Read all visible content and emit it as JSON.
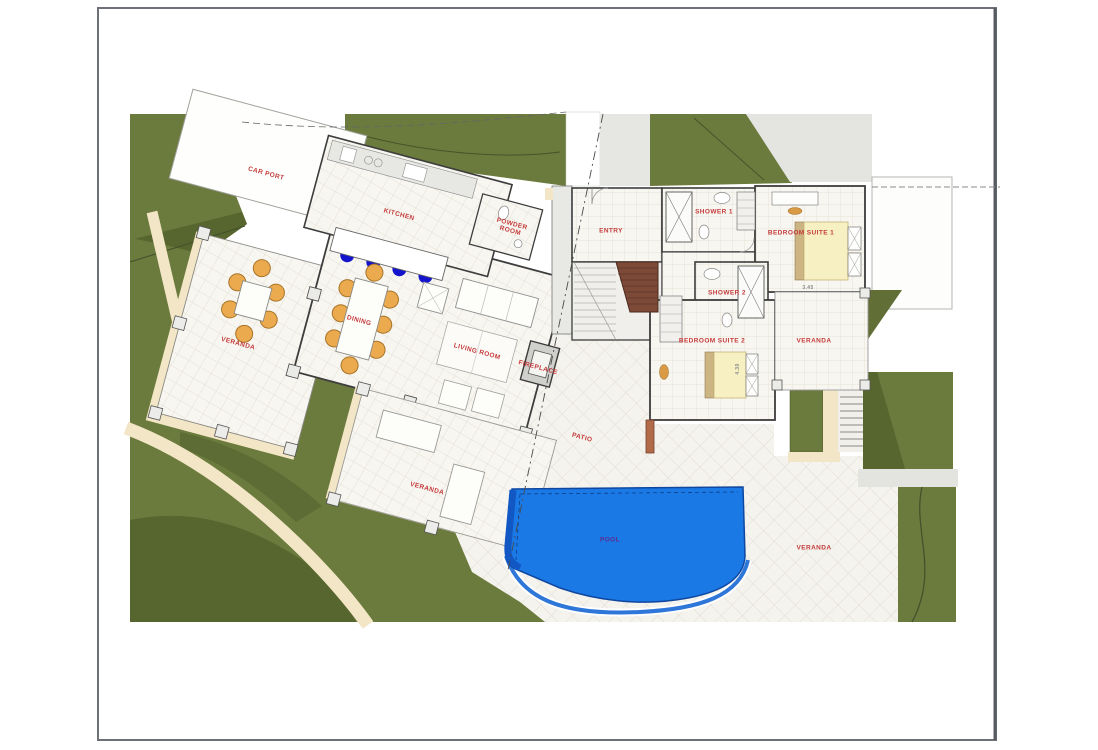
{
  "document": {
    "type": "architectural floor plan / site plan",
    "page_background": "#ffffff",
    "frame_border_color": "#6e7078"
  },
  "plan": {
    "room_labels": [
      {
        "id": "car-port",
        "text": "CAR PORT",
        "x": 266,
        "y": 174,
        "rot": 15,
        "size": 6.5,
        "color": "#c43b3b"
      },
      {
        "id": "kitchen",
        "text": "KITCHEN",
        "x": 399,
        "y": 215,
        "rot": 15,
        "size": 6.5,
        "color": "#c43b3b"
      },
      {
        "id": "powder-room",
        "text": "POWDER\nROOM",
        "x": 511,
        "y": 228,
        "rot": 15,
        "size": 6.5,
        "color": "#c43b3b"
      },
      {
        "id": "entry",
        "text": "ENTRY",
        "x": 611,
        "y": 231,
        "rot": 0,
        "size": 6.5,
        "color": "#c43b3b"
      },
      {
        "id": "shower-1",
        "text": "SHOWER 1",
        "x": 714,
        "y": 212,
        "rot": 0,
        "size": 6.5,
        "color": "#c43b3b"
      },
      {
        "id": "bedroom-suite-1",
        "text": "BEDROOM SUITE 1",
        "x": 801,
        "y": 233,
        "rot": 0,
        "size": 6.5,
        "color": "#c43b3b"
      },
      {
        "id": "shower-2",
        "text": "SHOWER 2",
        "x": 727,
        "y": 293,
        "rot": 0,
        "size": 6.5,
        "color": "#c43b3b"
      },
      {
        "id": "bedroom-suite-2",
        "text": "BEDROOM SUITE 2",
        "x": 712,
        "y": 341,
        "rot": 0,
        "size": 6.5,
        "color": "#c43b3b"
      },
      {
        "id": "veranda-east",
        "text": "VERANDA",
        "x": 814,
        "y": 341,
        "rot": 0,
        "size": 6.5,
        "color": "#c43b3b"
      },
      {
        "id": "veranda-west",
        "text": "VERANDA",
        "x": 238,
        "y": 344,
        "rot": 15,
        "size": 6.5,
        "color": "#c43b3b"
      },
      {
        "id": "dining",
        "text": "DINING",
        "x": 359,
        "y": 321,
        "rot": 15,
        "size": 6.5,
        "color": "#c43b3b"
      },
      {
        "id": "living-room",
        "text": "LIVING ROOM",
        "x": 477,
        "y": 352,
        "rot": 15,
        "size": 6.5,
        "color": "#c43b3b"
      },
      {
        "id": "fireplace",
        "text": "FIREPLACE",
        "x": 538,
        "y": 368,
        "rot": 15,
        "size": 6.5,
        "color": "#c43b3b"
      },
      {
        "id": "patio",
        "text": "PATIO",
        "x": 582,
        "y": 438,
        "rot": 15,
        "size": 6.5,
        "color": "#c43b3b"
      },
      {
        "id": "veranda-south",
        "text": "VERANDA",
        "x": 427,
        "y": 489,
        "rot": 15,
        "size": 6.5,
        "color": "#c43b3b"
      },
      {
        "id": "pool",
        "text": "POOL",
        "x": 610,
        "y": 540,
        "rot": 0,
        "size": 6.5,
        "color": "#5e2c8e"
      },
      {
        "id": "veranda-pool",
        "text": "VERANDA",
        "x": 814,
        "y": 548,
        "rot": 0,
        "size": 6.5,
        "color": "#c43b3b"
      }
    ],
    "dimension_labels": [
      {
        "id": "dim-bed1",
        "text": "3.45",
        "x": 808,
        "y": 289,
        "rot": 0,
        "size": 5,
        "color": "#8a8a8a"
      },
      {
        "id": "dim-bed2",
        "text": "4.30",
        "x": 739,
        "y": 369,
        "rot": -90,
        "size": 5,
        "color": "#8a8a8a"
      }
    ],
    "palette": {
      "grass_green": "#6b7a3d",
      "grass_dark": "#57652f",
      "path_beige": "#f3e6c6",
      "pool_blue": "#1b79e6",
      "pool_edge": "#0f47a0",
      "wall_dark": "#3d3d3d",
      "floor_tile": "#f8f6f1",
      "tile_line": "#e4e0d4",
      "chair_orange": "#ecaa4e",
      "bed_yellow": "#f7f0c2",
      "headboard_tan": "#cdb483",
      "stair_brown": "#7d4a37",
      "bar_stool_blue": "#1414cc",
      "label_red": "#c43b3b",
      "pool_label_purple": "#5e2c8e"
    }
  }
}
